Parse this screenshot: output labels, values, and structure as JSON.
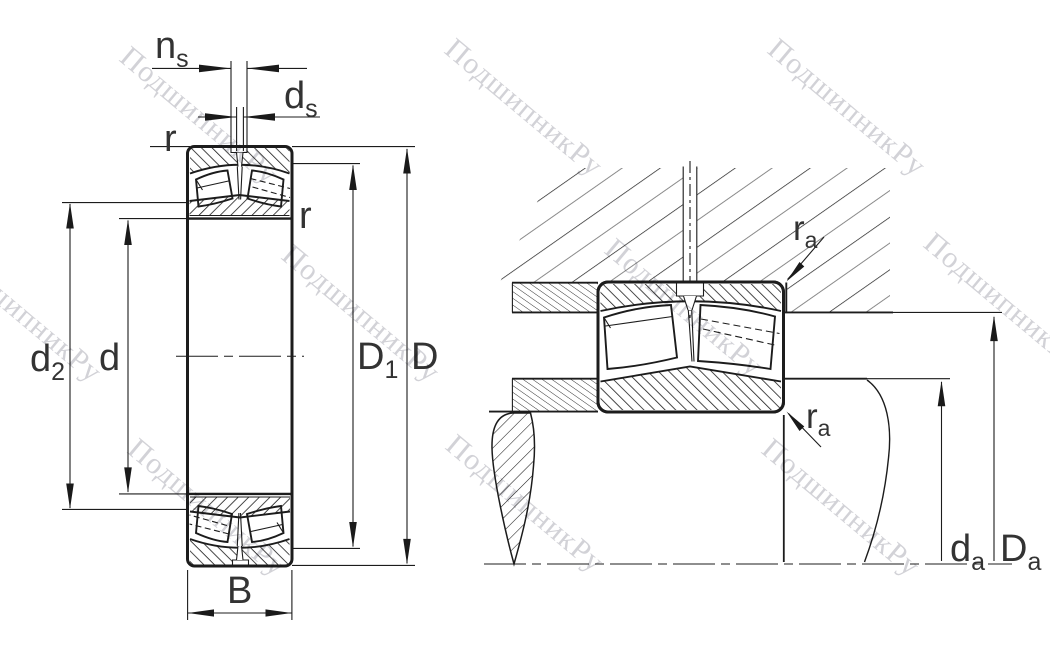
{
  "watermark": {
    "text": "ПодшипникРу"
  },
  "colors": {
    "line": "#1c1c1c",
    "label": "#333333",
    "watermark": "#d2d2d7",
    "hatch_gray": "#8a8a8a"
  },
  "left_view": {
    "labels": {
      "ns": {
        "base": "n",
        "sub": "s"
      },
      "ds": {
        "base": "d",
        "sub": "s"
      },
      "r_top": "r",
      "r_side": "r",
      "d2": {
        "base": "d",
        "sub": "2"
      },
      "d": "d",
      "D1": {
        "base": "D",
        "sub": "1"
      },
      "D": "D",
      "B": "B"
    }
  },
  "right_view": {
    "labels": {
      "ra_top": {
        "base": "r",
        "sub": "a"
      },
      "ra_bottom": {
        "base": "r",
        "sub": "a"
      },
      "da": {
        "base": "d",
        "sub": "a"
      },
      "Da": {
        "base": "D",
        "sub": "a"
      }
    }
  }
}
